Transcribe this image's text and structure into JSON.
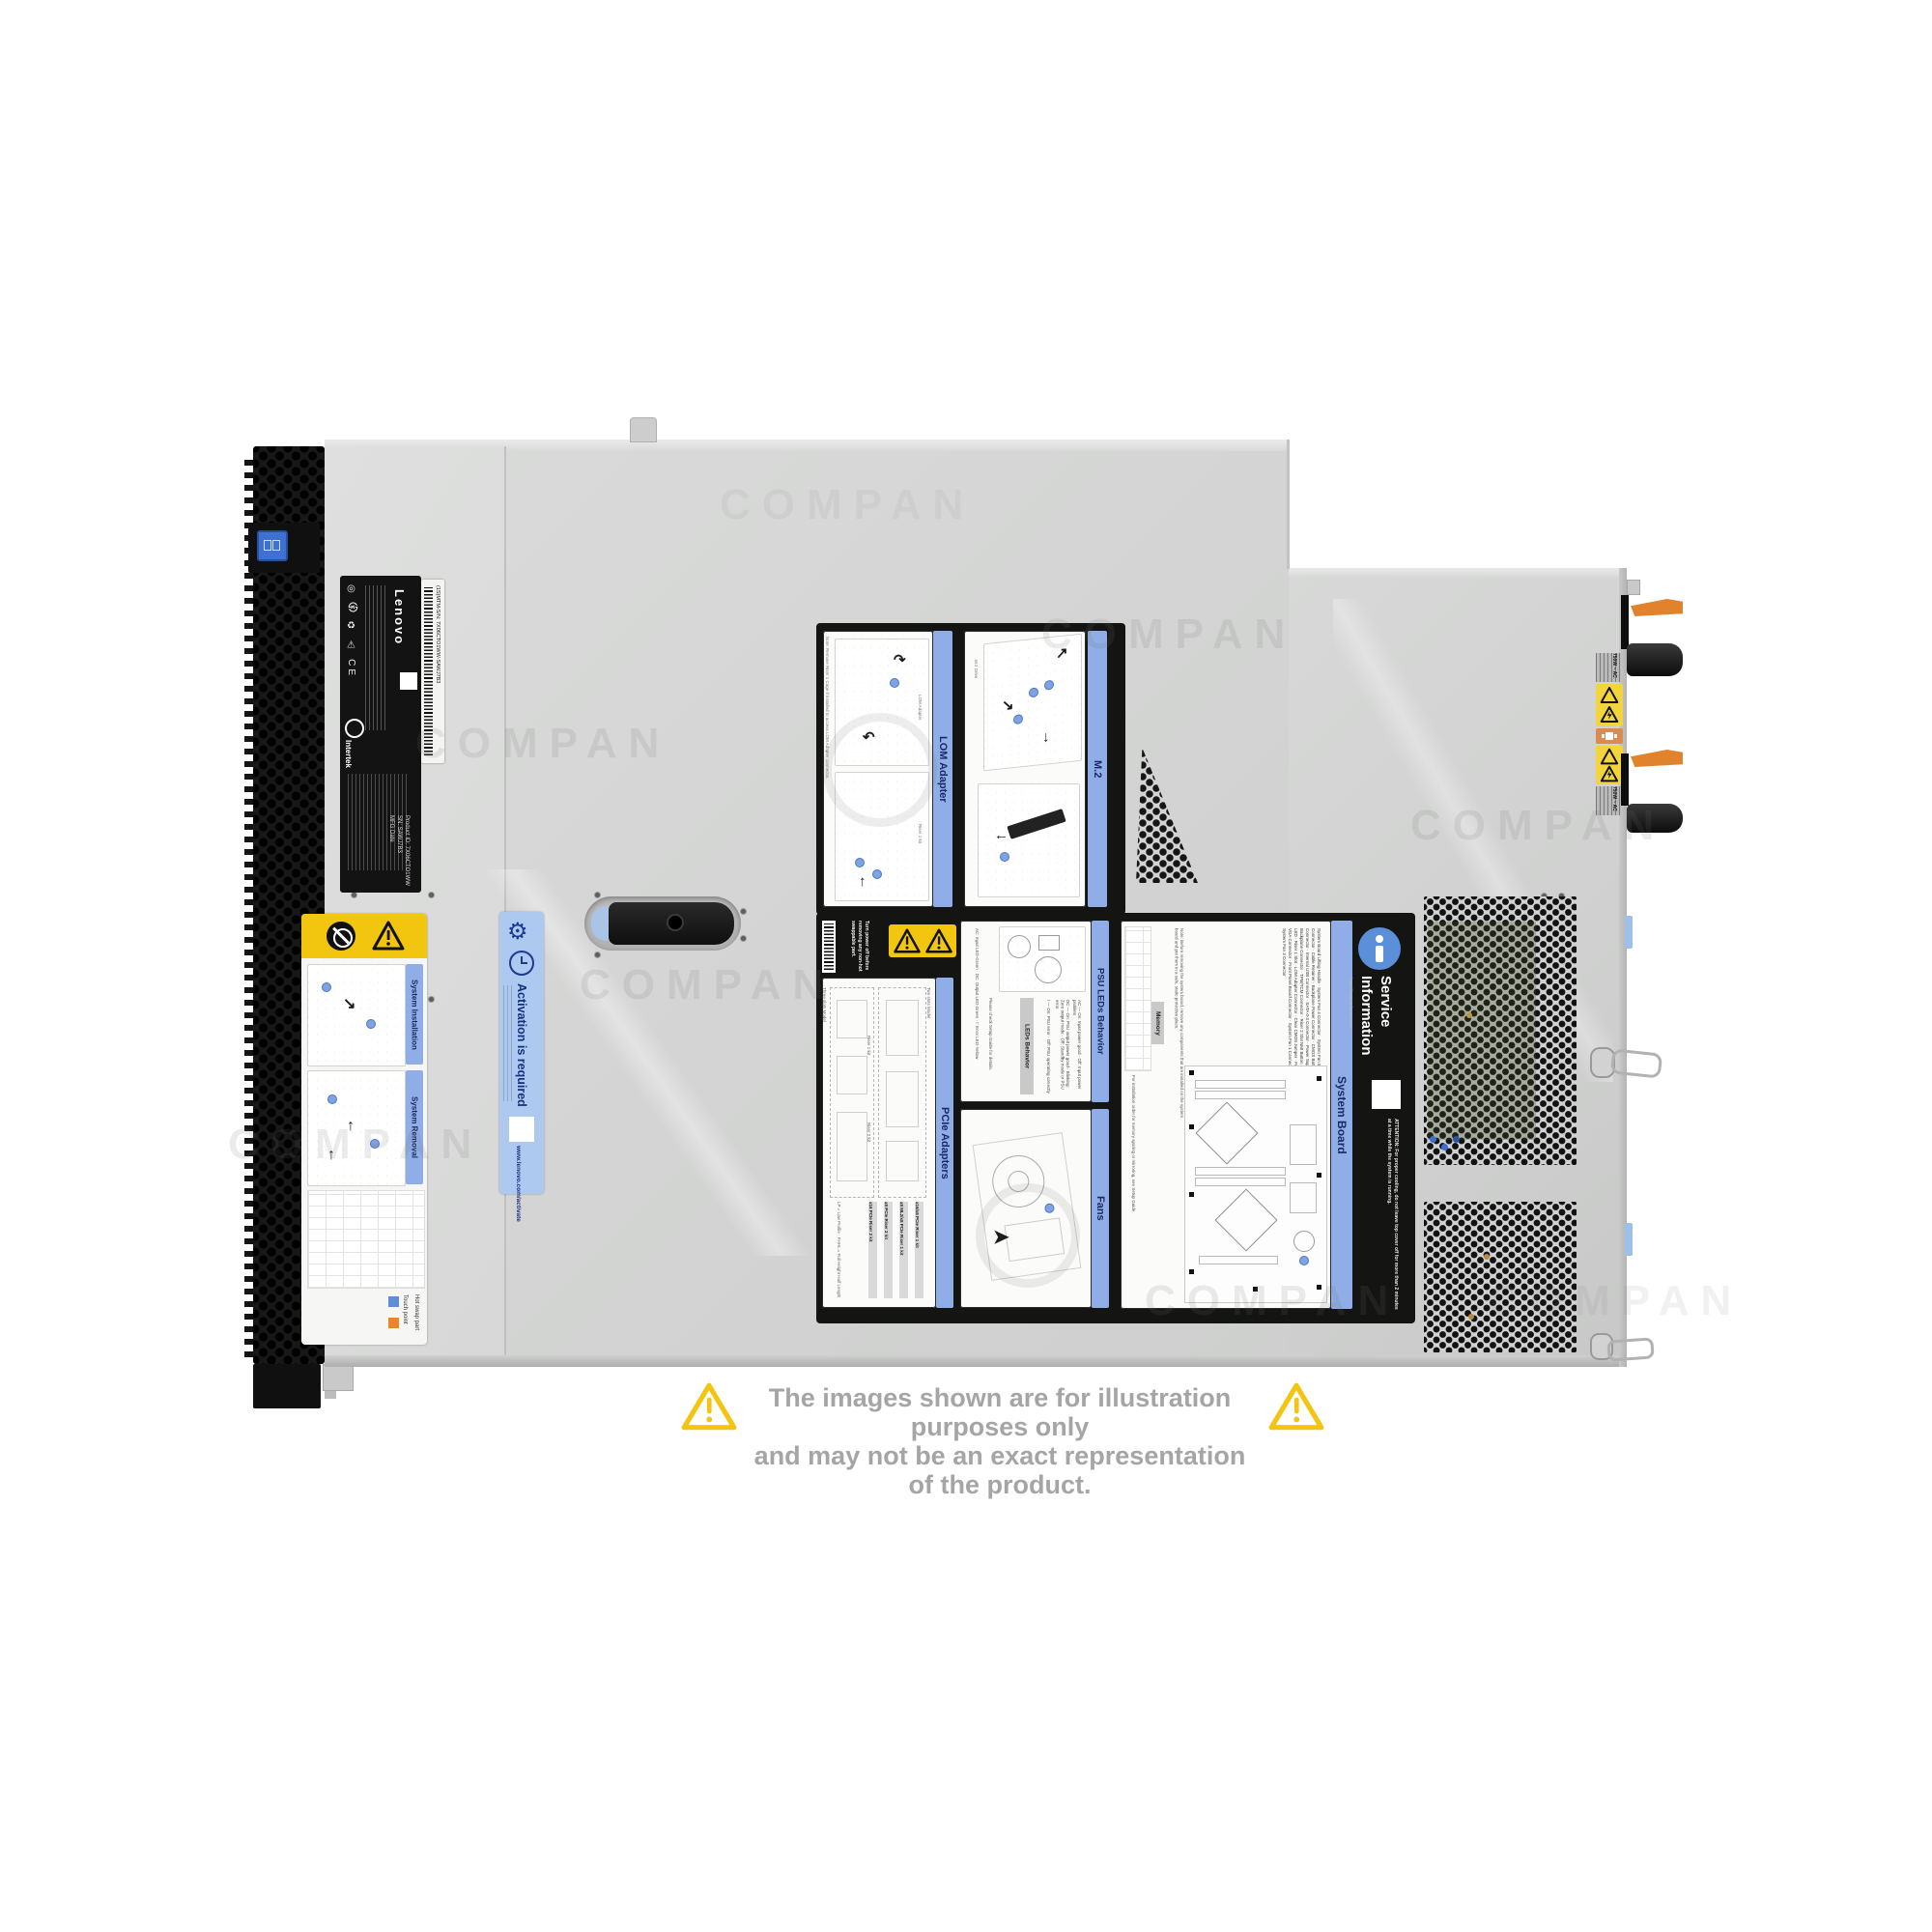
{
  "watermark": {
    "text": "COMPAN"
  },
  "disclaimer": {
    "line1": "The images shown are for illustration purposes only",
    "line2": "and may not be an exact representation of the product."
  },
  "chassis": {
    "asset_label": {
      "brand": "Lenovo",
      "certs": "◎ ㉿ ♻ ⚠ CE",
      "cert_badge": "Intertek",
      "sn_line": "SN: SAWJ7B3",
      "product_line": "Product ID: 7X06CTO1WW",
      "mfg_line": "MFG Date"
    },
    "barcode_label": {
      "text": "(1S)MTM-S/N: 7X06CTO1WW-SAWJ7B3"
    },
    "install_label": {
      "section1": "System Installation",
      "section2": "System Removal",
      "legend_touch": "Touch point",
      "legend_hot": "Hot swap part"
    },
    "activation_label": {
      "title": "Activation is required",
      "url": "www.lenovo.com/activate"
    },
    "psu": {
      "rating": "750W ~ AC"
    }
  },
  "service_label": {
    "warning": "Turn power off before removing any non-hot swappable part.",
    "lom": {
      "title": "LOM Adapter",
      "note": "Note: Remove Riser 1 Cage if installed to access LOM Adapter connector.",
      "cap1": "LOM Adapter",
      "cap2": "Riser 1 kit"
    },
    "m2": {
      "title": "M.2",
      "cap1": "Connector",
      "cap2": "M.2 Drive",
      "cap3": "Retainer"
    },
    "psu_leds": {
      "title": "PSU LEDs Behavior",
      "table_title": "LEDs Behavior",
      "row_ac": "AC — On: Input power good · Off: Input power problem",
      "row_dc": "DC — On: PSU output power good · Blinking: Zero output mode · Off: Standby mode or PSU error",
      "row_err": "! — On: PSU error · Off: PSU operating correctly",
      "legend": "AC: Input LED-Green · DC: Output LED-Green · !: Error LED-Yellow",
      "note": "Please check Setup Guide for details."
    },
    "pcie": {
      "title": "PCIe Adapters",
      "model1": "Two slots Model",
      "model2": "Three slots Model",
      "riser1": "Riser 1 kit",
      "riser2": "Riser 2 kit",
      "kit1": "x16/x8 PCIe Riser 1 kit",
      "kit2": "x8 ML2/x8 PCIe Riser 1 kit",
      "kit3": "x8 PCIe Riser 2 kit",
      "kit4": "x16 PCIe Riser 2 kit",
      "abbr": "LP = Low Profile · FHHL = Full Height Half Length"
    },
    "fans": {
      "title": "Fans"
    },
    "board": {
      "title": "System Board",
      "memory_title": "Memory",
      "memory_note": "For installation order for memory sparing or mirroring, see Setup Guide.",
      "note": "Note: Before removing the system board, remove any components that are installed on the system board and put them in a safe, static-protective place.",
      "legend_col1": "NMI Button · System Error LED · System ID LED · Riser 1 Slot · LOM Adapter Connector · Clear CMOS Jumper · Front USB Connector · Front VGA Connector · Front Panel Board Connector · System Fan 1 Connector · System Fan 2 Connector · System Fan 3 Connector",
      "legend_col2": "System Board Lifting Handle · System Fan 4 Connector · System Fan 5 Connector · System Fan 6 Connector · Cable Retainer · Backplane Power Connector · CMOS Battery · Power Supply 2 Connector · Internal USB Connector · SATA 0-3 Connector · Power Supply 1 Connector · M.2 Backplane Connector · TPM/TCM Connector · Riser 2 Slot"
    },
    "service_info": {
      "title": "Service\nInformation",
      "url": "https://support.lenovo.com",
      "attention": "ATTENTION: For proper cooling, do not leave top cover off for more than 2 minutes at a time while the system is running."
    }
  }
}
